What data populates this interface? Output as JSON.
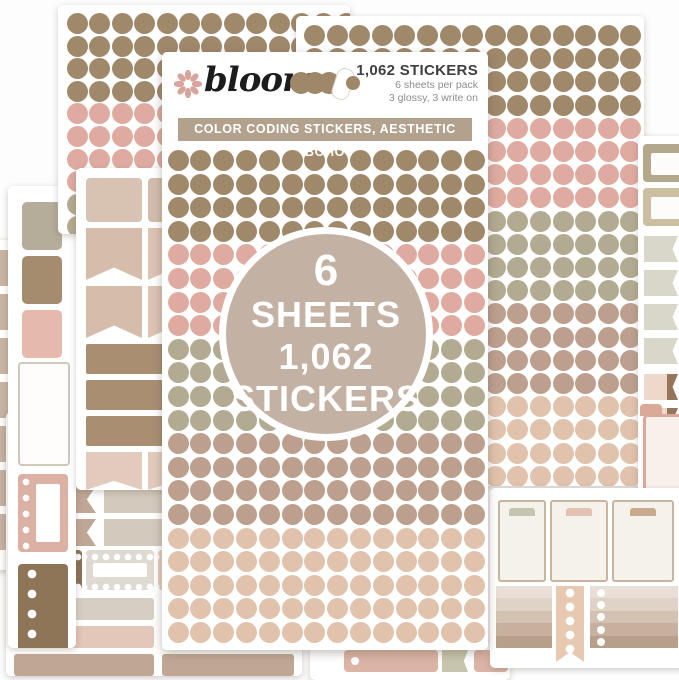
{
  "product": {
    "brand": "bloom",
    "header": {
      "count_label": "1,062 STICKERS",
      "pack_line1": "6 sheets per pack",
      "pack_line2": "3 glossy, 3 write on"
    },
    "banner_text": "COLOR CODING STICKERS, AESTHETIC BOHO",
    "badge_lines": [
      "6",
      "SHEETS",
      "1,062",
      "STICKERS"
    ]
  },
  "palette": {
    "brown": "#a0886b",
    "pink": "#dfaba0",
    "sage": "#b2ab91",
    "taupe": "#bd9f8e",
    "peach": "#e1c2ad",
    "banner_bg": "#b2a18c",
    "badge_bg": "#c3b1a3",
    "flower_pink": "#d9a49c",
    "text_dark": "#3f3f3f",
    "text_gray": "#8d8d8d"
  },
  "dot_sheets": {
    "main": {
      "cols": 14,
      "dot": 21,
      "x0": 5.5,
      "y0": 98,
      "px": 22.8,
      "py": 23.6,
      "bands": [
        [
          "brown",
          4
        ],
        [
          "pink",
          4
        ],
        [
          "sage",
          4
        ],
        [
          "taupe",
          4
        ],
        [
          "peach",
          5
        ]
      ]
    },
    "topleft": {
      "cols": 13,
      "dot": 21,
      "x0": 9,
      "y0": 8,
      "px": 22.4,
      "py": 22.6,
      "bands": [
        [
          "brown",
          4
        ],
        [
          "pink",
          4
        ],
        [
          "sage",
          3
        ]
      ]
    },
    "topright": {
      "cols": 15,
      "dot": 21,
      "x0": 8,
      "y0": 9,
      "px": 22.6,
      "py": 23.2,
      "bands": [
        [
          "brown",
          4
        ],
        [
          "pink",
          4
        ],
        [
          "sage",
          4
        ],
        [
          "taupe",
          4
        ],
        [
          "peach",
          4
        ]
      ]
    }
  }
}
